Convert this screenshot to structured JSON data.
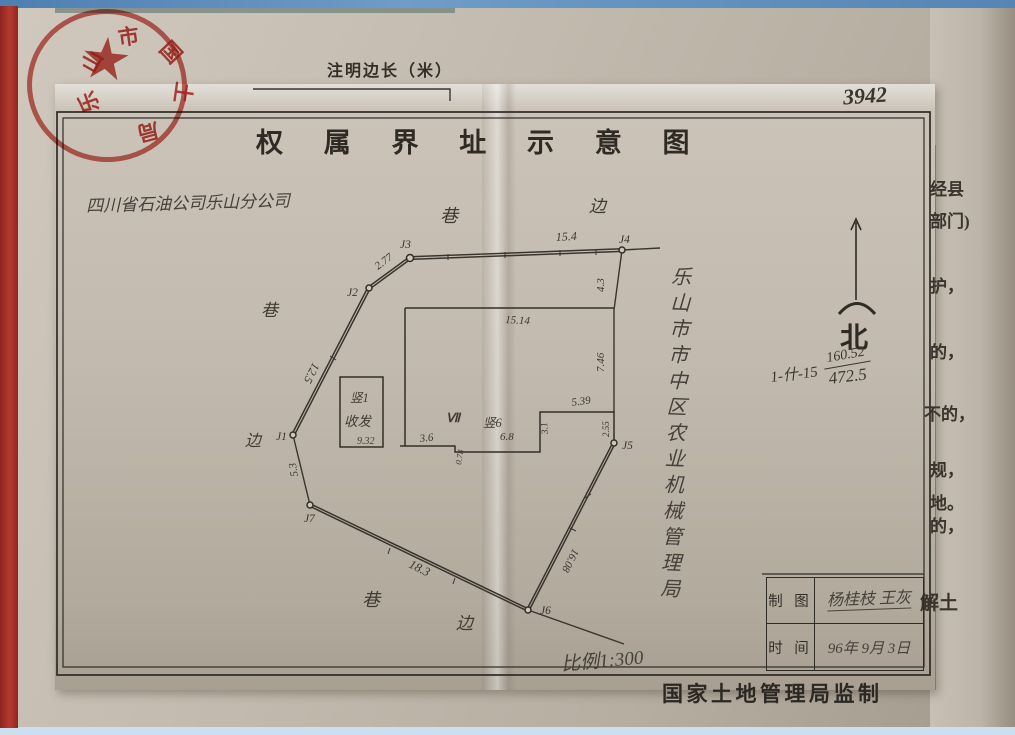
{
  "header": {
    "note": "注明边长（米）",
    "sheet_number": "3942",
    "title": "权 属 界 址 示 意 图"
  },
  "parties": {
    "left_handwritten": "四川省石油公司乐山分公司",
    "right_vertical": "乐山市市中区农业机械管理局"
  },
  "stamp": {
    "star": "★",
    "chars": [
      "乐",
      "山",
      "市",
      "国",
      "土",
      "局"
    ]
  },
  "compass": {
    "north": "北"
  },
  "calc": {
    "prefix": "1-什-15",
    "numerator": "160.52",
    "denominator": "472.5"
  },
  "diagram": {
    "points": {
      "j1": "J1",
      "j2": "J2",
      "j3": "J3",
      "j4": "J4",
      "j5": "J5",
      "j6": "J6",
      "j7": "J7"
    },
    "edges": {
      "j1j2": "12.5",
      "j2j3": "2.77",
      "j3j4": "15.4",
      "j4a": "4.3",
      "rect_top": "15.14",
      "rect_right": "7.46",
      "step_top": "5.39",
      "step_right": "2.55",
      "step_up": "3.1",
      "bottom_mid": "6.8",
      "bottom_step": "0.78",
      "bottom_left": "3.6",
      "j5j6": "16.08",
      "j6j7": "18.3",
      "j7j1": "5.3"
    },
    "buildings": {
      "small_line1": "竖1",
      "small_line2": "收发",
      "small_area": "9.32",
      "big_mark": "Ⅶ",
      "big_label": "竖6"
    },
    "streets": {
      "top_lane": "巷",
      "top_side": "边",
      "left_lane": "巷",
      "left_side": "边",
      "bottom_lane": "巷",
      "bottom_side": "边"
    },
    "scale": "比例1:300"
  },
  "margin_fragments": {
    "f1": "经县",
    "f2": "部门)",
    "f3": "护，",
    "f4": "的，",
    "f5": "不的，",
    "f6": "规，",
    "f7": "地。",
    "f8": "的，",
    "f9": "解土"
  },
  "table": {
    "row1_label": "制 图",
    "row1_value": "杨桂枝 王灰",
    "row2_label": "时 间",
    "row2_value": "96年 9月 3日"
  },
  "footer": {
    "supervised": "国家土地管理局监制"
  }
}
